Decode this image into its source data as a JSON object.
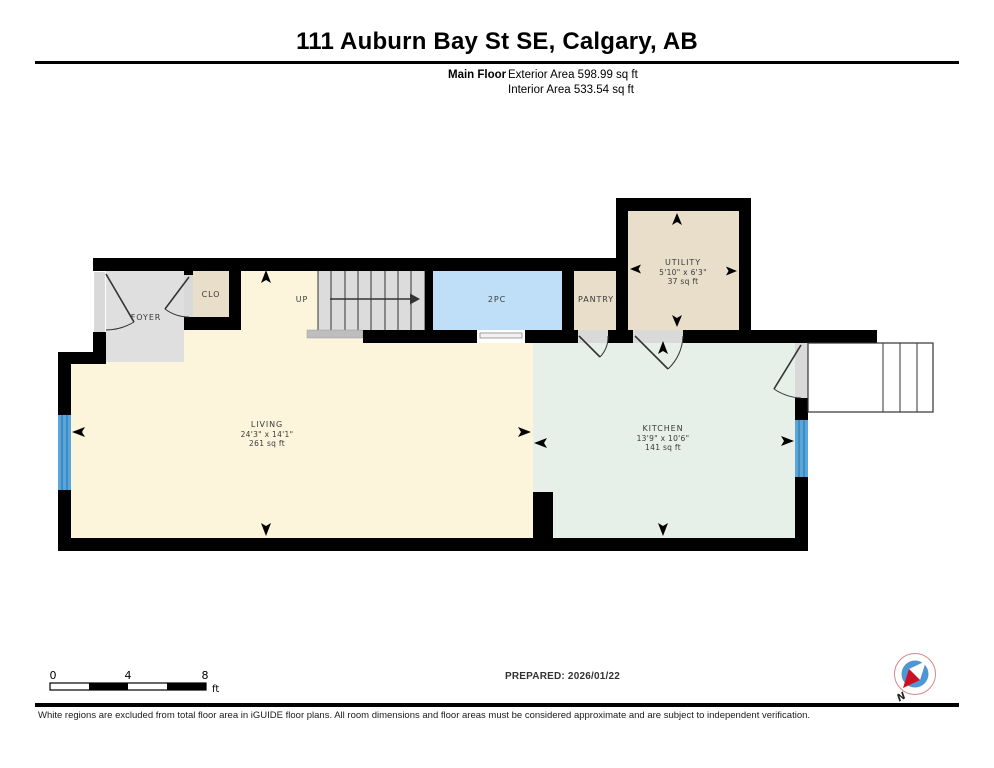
{
  "header": {
    "title": "111 Auburn Bay St SE, Calgary, AB",
    "floor_label": "Main Floor",
    "exterior_area": "Exterior Area 598.99 sq ft",
    "interior_area": "Interior Area 533.54 sq ft"
  },
  "rooms": {
    "foyer": {
      "name": "FOYER"
    },
    "closet": {
      "name": "CLO"
    },
    "stairs": {
      "label": "UP"
    },
    "bath": {
      "name": "2PC"
    },
    "pantry": {
      "name": "PANTRY"
    },
    "utility": {
      "name": "UTILITY",
      "dims": "5'10\" x 6'3\"",
      "area": "37 sq ft"
    },
    "living": {
      "name": "LIVING",
      "dims": "24'3\" x 14'1\"",
      "area": "261 sq ft"
    },
    "kitchen": {
      "name": "KITCHEN",
      "dims": "13'9\" x 10'6\"",
      "area": "141 sq ft"
    }
  },
  "scale_bar": {
    "tick_0": "0",
    "tick_4": "4",
    "tick_8": "8",
    "unit": "ft"
  },
  "compass": {
    "north_label": "N"
  },
  "footer": {
    "prepared": "PREPARED: 2026/01/22",
    "disclaimer": "White regions are excluded from total floor area in iGUIDE floor plans. All room dimensions and floor areas must be considered approximate and are subject to independent verification."
  },
  "colors": {
    "wall": "#000000",
    "living_floor": "#FCF5DC",
    "kitchen_floor": "#E6EFE8",
    "foyer_floor": "#DFDFDF",
    "closet_floor": "#E8DECA",
    "bath_floor": "#BFDFF8",
    "stairs_floor": "#DCDCDC",
    "threshold": "#D9D9D9",
    "window_blue": "#57A7DD",
    "compass_blue": "#5096D2",
    "compass_red": "#CC1122"
  }
}
